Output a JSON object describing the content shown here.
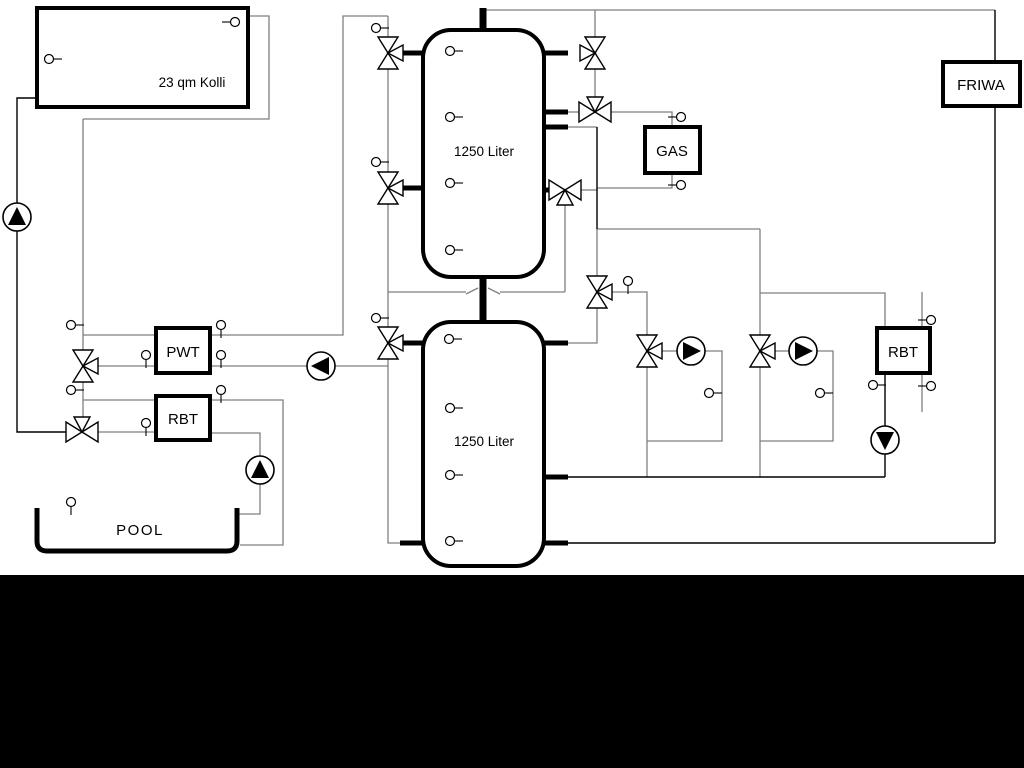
{
  "diagram": {
    "type": "hydraulic-heating-schematic",
    "labels": {
      "collector": "23 qm Kolli",
      "buffer_tank_top": "1250 Liter",
      "buffer_tank_bottom": "1250 Liter",
      "pwt": "PWT",
      "rbt_left": "RBT",
      "pool": "POOL",
      "gas": "GAS",
      "friwa": "FRIWA",
      "rbt_right": "RBT"
    },
    "colors": {
      "pipe_gray": "#7f7f7f",
      "pipe_black": "#000000",
      "background": "#ffffff",
      "bottom_bar": "#000000"
    }
  }
}
